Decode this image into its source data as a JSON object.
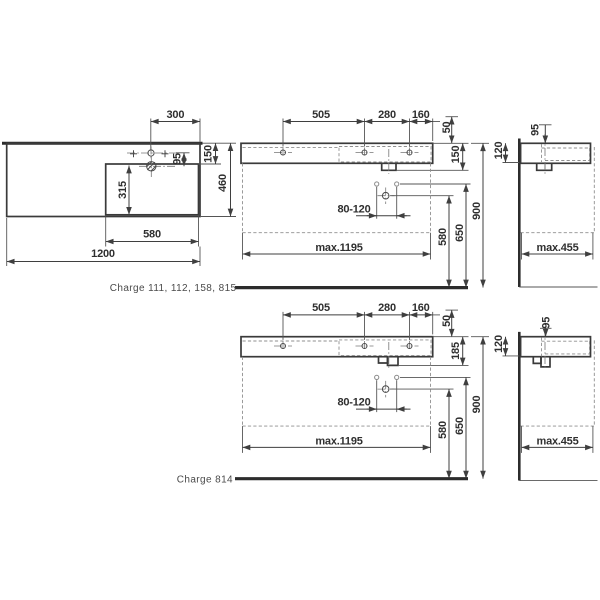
{
  "top": {
    "label": "Charge 111, 112, 158, 815",
    "plan": {
      "tap_from_right_300": "300",
      "tap_to_bowl_95": "95",
      "back_to_bowl_150": "150",
      "total_depth_460": "460",
      "bowl_depth_315": "315",
      "bowl_width_580": "580",
      "total_width_1200": "1200"
    },
    "front": {
      "tap_spacing_505": "505",
      "tap_spacing_280": "280",
      "tap_to_edge_160": "160",
      "tap_offset_50": "50",
      "body_height_150": "150",
      "fixing_range_80_120": "80-120",
      "drain_height_580": "580",
      "fixing_height_650": "650",
      "rim_height_900": "900",
      "max_width": "max.1195"
    },
    "side": {
      "tap_from_wall_95": "95",
      "wall_height_120": "120",
      "max_depth": "max.455"
    }
  },
  "bottom": {
    "label": "Charge 814",
    "front": {
      "tap_spacing_505": "505",
      "tap_spacing_280": "280",
      "tap_to_edge_160": "160",
      "tap_offset_50": "50",
      "body_height_185": "185",
      "fixing_range_80_120": "80-120",
      "drain_height_580": "580",
      "fixing_height_650": "650",
      "rim_height_900": "900",
      "max_width": "max.1195"
    },
    "side": {
      "tap_from_wall_95": "95",
      "wall_height_120": "120",
      "max_depth": "max.455"
    }
  },
  "colors": {
    "line": "#3a3a3a",
    "thick": "#2c2c2c",
    "dashed": "#8f8f8f",
    "text": "#2f2f2f",
    "label": "#4a4a4a"
  }
}
